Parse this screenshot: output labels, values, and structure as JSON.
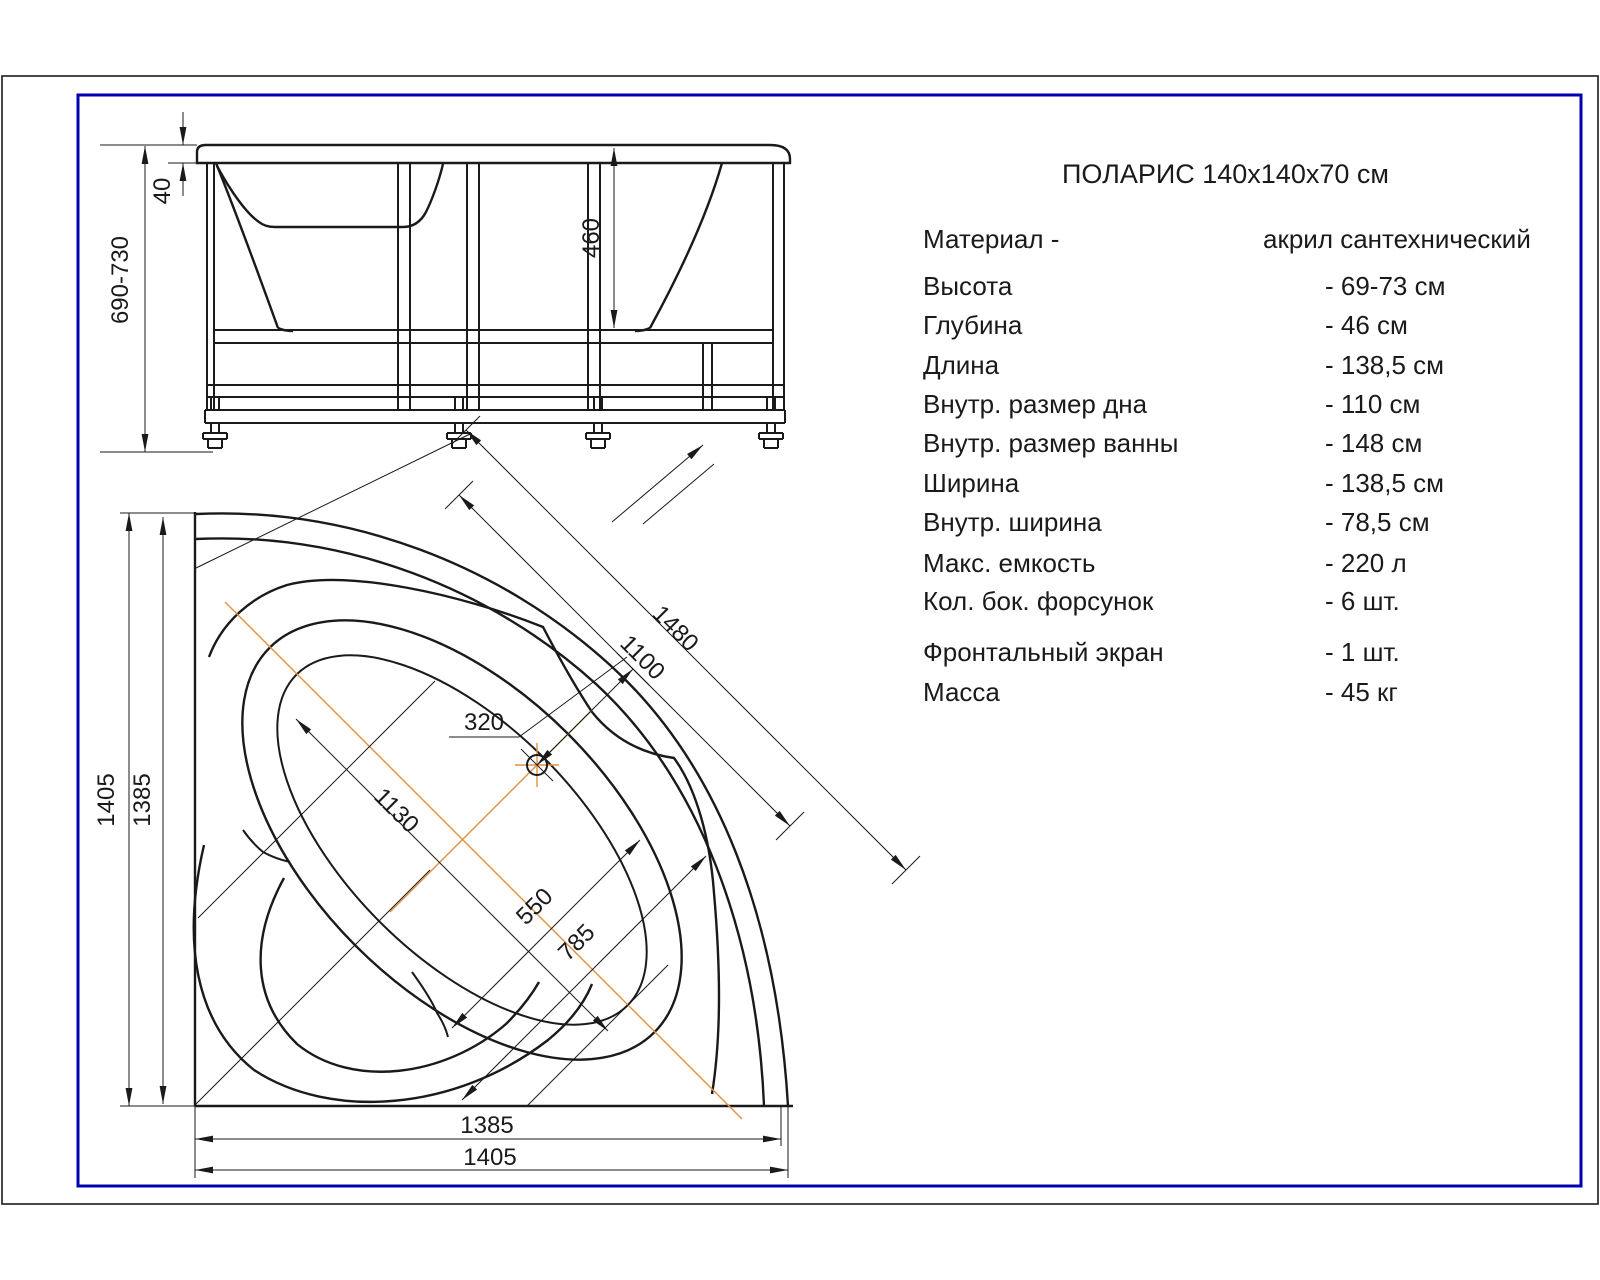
{
  "drawing_title": "ПОЛАРИС 140x140x70 см",
  "specs": {
    "rows": [
      {
        "label": "Материал -",
        "value": "акрил сантехнический"
      },
      {
        "label": "Высота",
        "value": "- 69-73 см"
      },
      {
        "label": "Глубина",
        "value": "- 46 см"
      },
      {
        "label": "Длина",
        "value": "- 138,5 см"
      },
      {
        "label": "Внутр. размер дна",
        "value": "- 110 см"
      },
      {
        "label": "Внутр. размер ванны",
        "value": "- 148 см"
      },
      {
        "label": "Ширина",
        "value": "- 138,5 см"
      },
      {
        "label": "Внутр. ширина",
        "value": "- 78,5 см"
      },
      {
        "label": "Макс. емкость",
        "value": "- 220 л"
      },
      {
        "label": "Кол. бок. форсунок",
        "value": "- 6 шт."
      },
      {
        "label": "Фронтальный экран",
        "value": "- 1 шт."
      },
      {
        "label": "Масса",
        "value": "- 45 кг"
      }
    ]
  },
  "dimensions": {
    "side_view": {
      "overall_height": "690-730",
      "rim_thickness": "40",
      "inner_depth": "460"
    },
    "plan_view": {
      "left_outer": "1405",
      "left_inner": "1385",
      "bottom_inner": "1385",
      "bottom_outer": "1405",
      "diagonal_overall": "1480",
      "diagonal_inner": "1100",
      "basin_length": "1130",
      "basin_width_inner": "550",
      "basin_width_outer": "785",
      "drain_offset": "320"
    }
  },
  "colors": {
    "line": "#1a1a1a",
    "centerline": "#e0913d",
    "border_frame": "#0000b2"
  }
}
